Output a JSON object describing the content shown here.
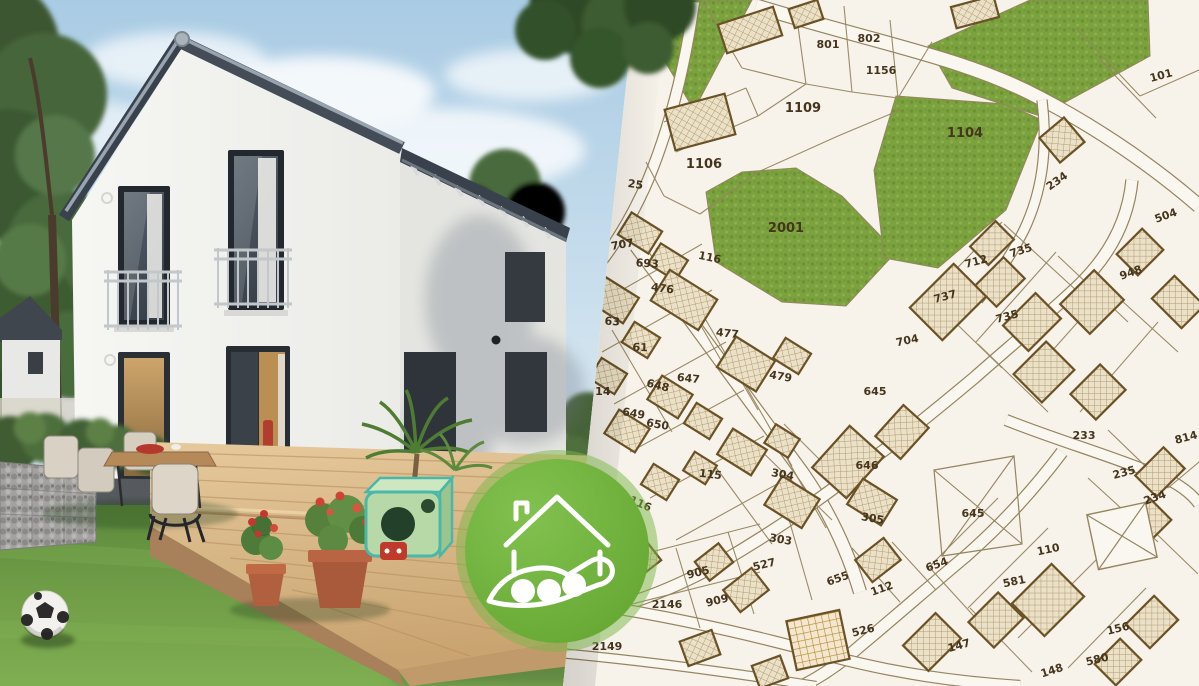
{
  "map": {
    "type": "cadastral-parcel-map",
    "colors": {
      "background": "#f7f3eb",
      "road_fill": "#faf7f0",
      "parcel_line": "#95855f",
      "building_outline": "#6b5226",
      "building_fill": "#e7dcc2",
      "green_fill": "#7ba23e",
      "label_color": "#45351d"
    },
    "green_areas": [
      "628,0 752,0 694,110",
      "706,192 742,172 796,168 842,196 896,252 846,306 782,302 716,262",
      "896,96 1006,104 1042,120 1006,210 938,268 884,258 874,170",
      "928,46 1030,0 1148,0 1150,56 1040,116 952,88"
    ],
    "roads": [
      {
        "d": "M756,6 C880,44 965,58 1040,98 C1105,132 1160,172 1199,206",
        "w": 13
      },
      {
        "d": "M1042,100 C1048,150 1042,192 1024,230 C1010,258 994,280 978,300",
        "w": 9
      },
      {
        "d": "M1132,180 C1128,222 1108,258 1076,288 C1044,318 1008,348 974,378 C938,408 904,436 868,462",
        "w": 11
      },
      {
        "d": "M636,246 C692,322 748,398 802,472 C830,512 848,552 860,592",
        "w": 12
      },
      {
        "d": "M868,462 C820,500 770,534 718,564 C672,590 622,608 572,618",
        "w": 11
      },
      {
        "d": "M1006,420 C1062,442 1112,456 1160,476 C1178,483 1192,494 1199,504",
        "w": 10
      },
      {
        "d": "M1062,452 C1032,492 1000,526 966,556 C930,586 896,616 860,646 C842,662 822,676 802,686",
        "w": 11
      },
      {
        "d": "M560,600 C652,612 742,632 830,656 C898,674 958,682 1020,686",
        "w": 10
      },
      {
        "d": "M548,652 C640,660 728,672 816,686",
        "w": 8
      },
      {
        "d": "M694,2 C686,60 672,122 648,180 C630,222 610,252 590,276",
        "w": 10
      }
    ],
    "parcel_lines": "M702,0L742,68M742,68L806,84M806,84L796,12M844,6L852,92M806,84L852,92M852,92L898,98M890,20L898,98M898,98L932,42M664,122L746,88M676,152L758,116M758,116L806,84M700,214L758,172M758,172L838,136M838,136L900,110M746,88L758,116M646,162L664,196M664,196L700,214M594,306L702,244M602,352L712,290M614,404L726,342M630,452L744,390M650,498L764,436M676,540L788,478M656,248L722,362M612,330L672,432M692,296L758,410M726,352L792,466M762,414L826,528M1002,222L928,298M1056,252L976,342M1108,288L1028,378M1158,322L1080,412M930,298L1002,368M978,344L1048,412M1004,224L1078,292M1058,256L1128,322M1110,290L1178,352M998,498L928,568M1048,528L968,608M1098,558L1018,638M1146,588L1068,668M930,568L992,636M970,608L1032,672M1088,478L1158,542M1134,512L1198,574M676,548L700,628M728,532L754,614M788,516L812,600M748,438L832,520M784,424L862,502M712,462L772,544M852,548L900,602M892,542L936,590M1076,28L1140,96M1140,96L1199,70M1100,60L1156,118M1108,430L1168,488M1168,488L1199,462M620,560L760,524M624,606L760,572",
    "buildings": [
      [
        750,
        30,
        58,
        30,
        -18
      ],
      [
        806,
        14,
        30,
        20,
        -18
      ],
      [
        700,
        122,
        62,
        42,
        -15
      ],
      [
        975,
        12,
        44,
        22,
        -15
      ],
      [
        1062,
        140,
        32,
        32,
        -40
      ],
      [
        640,
        233,
        36,
        26,
        32
      ],
      [
        668,
        262,
        32,
        24,
        32
      ],
      [
        684,
        300,
        56,
        36,
        32
      ],
      [
        614,
        300,
        40,
        30,
        32
      ],
      [
        641,
        340,
        30,
        24,
        32
      ],
      [
        746,
        364,
        46,
        36,
        32
      ],
      [
        792,
        356,
        30,
        24,
        32
      ],
      [
        608,
        376,
        30,
        24,
        32
      ],
      [
        670,
        397,
        36,
        28,
        32
      ],
      [
        703,
        421,
        30,
        24,
        32
      ],
      [
        627,
        431,
        36,
        28,
        32
      ],
      [
        742,
        452,
        40,
        30,
        32
      ],
      [
        782,
        441,
        28,
        22,
        32
      ],
      [
        700,
        468,
        26,
        22,
        32
      ],
      [
        660,
        482,
        30,
        24,
        32
      ],
      [
        792,
        502,
        44,
        34,
        32
      ],
      [
        848,
        462,
        56,
        46,
        -48
      ],
      [
        902,
        432,
        42,
        34,
        -48
      ],
      [
        872,
        502,
        40,
        30,
        32
      ],
      [
        948,
        302,
        62,
        46,
        -45
      ],
      [
        1000,
        282,
        40,
        30,
        -45
      ],
      [
        1032,
        322,
        46,
        36,
        -45
      ],
      [
        992,
        243,
        36,
        26,
        -45
      ],
      [
        1092,
        302,
        48,
        42,
        -45
      ],
      [
        1140,
        252,
        36,
        30,
        -45
      ],
      [
        1178,
        302,
        32,
        42,
        -45
      ],
      [
        1098,
        392,
        42,
        36,
        -45
      ],
      [
        1044,
        372,
        46,
        40,
        -45
      ],
      [
        1160,
        472,
        40,
        30,
        -45
      ],
      [
        1148,
        522,
        36,
        30,
        -45
      ],
      [
        1048,
        600,
        56,
        46,
        -45
      ],
      [
        996,
        620,
        42,
        36,
        -45
      ],
      [
        932,
        642,
        46,
        36,
        -45
      ],
      [
        1118,
        662,
        36,
        30,
        -45
      ],
      [
        1152,
        622,
        40,
        34,
        -45
      ],
      [
        746,
        590,
        36,
        28,
        -38
      ],
      [
        714,
        562,
        30,
        24,
        -38
      ],
      [
        878,
        560,
        36,
        28,
        -38
      ],
      [
        642,
        560,
        30,
        24,
        -38
      ],
      [
        700,
        648,
        34,
        26,
        -20
      ],
      [
        770,
        672,
        30,
        24,
        -20
      ]
    ],
    "grid_building": [
      818,
      640,
      54,
      50,
      -12
    ],
    "crossed_building": [
      1122,
      536,
      60,
      56,
      -12
    ],
    "crossed_parcel": "934,470 1014,456 1022,544 942,556",
    "parcel_labels": [
      {
        "t": "801",
        "x": 828,
        "y": 48,
        "r": 0
      },
      {
        "t": "802",
        "x": 869,
        "y": 42,
        "r": 0
      },
      {
        "t": "1156",
        "x": 881,
        "y": 74,
        "r": 0
      },
      {
        "t": "101",
        "x": 1162,
        "y": 79,
        "r": -15
      },
      {
        "t": "1109",
        "x": 803,
        "y": 112,
        "r": 0,
        "s": 13
      },
      {
        "t": "1104",
        "x": 965,
        "y": 137,
        "r": 0,
        "s": 13
      },
      {
        "t": "1106",
        "x": 704,
        "y": 168,
        "r": 0,
        "s": 13
      },
      {
        "t": "25",
        "x": 635,
        "y": 188,
        "r": 8
      },
      {
        "t": "234",
        "x": 1059,
        "y": 184,
        "r": -35
      },
      {
        "t": "2001",
        "x": 786,
        "y": 232,
        "r": 0,
        "s": 13
      },
      {
        "t": "707",
        "x": 623,
        "y": 248,
        "r": -10
      },
      {
        "t": "116",
        "x": 709,
        "y": 261,
        "r": 12
      },
      {
        "t": "693",
        "x": 647,
        "y": 267,
        "r": 4
      },
      {
        "t": "476",
        "x": 662,
        "y": 292,
        "r": 8
      },
      {
        "t": "735",
        "x": 1022,
        "y": 254,
        "r": -18
      },
      {
        "t": "712",
        "x": 977,
        "y": 265,
        "r": -15
      },
      {
        "t": "737",
        "x": 946,
        "y": 300,
        "r": -15
      },
      {
        "t": "504",
        "x": 1167,
        "y": 219,
        "r": -20
      },
      {
        "t": "63",
        "x": 612,
        "y": 325,
        "r": 4
      },
      {
        "t": "735",
        "x": 1008,
        "y": 320,
        "r": -15
      },
      {
        "t": "477",
        "x": 727,
        "y": 337,
        "r": 6
      },
      {
        "t": "704",
        "x": 908,
        "y": 344,
        "r": -12
      },
      {
        "t": "61",
        "x": 640,
        "y": 351,
        "r": 2
      },
      {
        "t": "948",
        "x": 1132,
        "y": 276,
        "r": -20
      },
      {
        "t": "647",
        "x": 688,
        "y": 382,
        "r": 6
      },
      {
        "t": "648",
        "x": 657,
        "y": 389,
        "r": 14
      },
      {
        "t": "479",
        "x": 780,
        "y": 380,
        "r": 10
      },
      {
        "t": "714",
        "x": 599,
        "y": 395,
        "r": 0
      },
      {
        "t": "645",
        "x": 875,
        "y": 395,
        "r": 0
      },
      {
        "t": "649",
        "x": 633,
        "y": 417,
        "r": 10
      },
      {
        "t": "650",
        "x": 657,
        "y": 428,
        "r": 10
      },
      {
        "t": "233",
        "x": 1084,
        "y": 439,
        "r": 0
      },
      {
        "t": "814",
        "x": 1187,
        "y": 441,
        "r": -15
      },
      {
        "t": "646",
        "x": 867,
        "y": 469,
        "r": 0
      },
      {
        "t": "115",
        "x": 710,
        "y": 478,
        "r": 6
      },
      {
        "t": "304",
        "x": 782,
        "y": 478,
        "r": 10
      },
      {
        "t": "235",
        "x": 1125,
        "y": 476,
        "r": -15
      },
      {
        "t": "234",
        "x": 1156,
        "y": 501,
        "r": -20
      },
      {
        "t": "116",
        "x": 639,
        "y": 507,
        "r": 24
      },
      {
        "t": "645",
        "x": 973,
        "y": 517,
        "r": 0
      },
      {
        "t": "305",
        "x": 872,
        "y": 522,
        "r": 10
      },
      {
        "t": "303",
        "x": 780,
        "y": 543,
        "r": 10
      },
      {
        "t": "110",
        "x": 1049,
        "y": 553,
        "r": -12
      },
      {
        "t": "654",
        "x": 938,
        "y": 568,
        "r": -20
      },
      {
        "t": "905",
        "x": 699,
        "y": 576,
        "r": -14
      },
      {
        "t": "527",
        "x": 765,
        "y": 568,
        "r": -14
      },
      {
        "t": "655",
        "x": 839,
        "y": 582,
        "r": -20
      },
      {
        "t": "112",
        "x": 883,
        "y": 592,
        "r": -20
      },
      {
        "t": "581",
        "x": 1015,
        "y": 585,
        "r": -12
      },
      {
        "t": "909",
        "x": 718,
        "y": 604,
        "r": -14
      },
      {
        "t": "2146",
        "x": 667,
        "y": 608,
        "r": 0
      },
      {
        "t": "526",
        "x": 864,
        "y": 634,
        "r": -14
      },
      {
        "t": "156",
        "x": 1119,
        "y": 632,
        "r": -14
      },
      {
        "t": "2149",
        "x": 607,
        "y": 650,
        "r": 0
      },
      {
        "t": "147",
        "x": 960,
        "y": 649,
        "r": -16
      },
      {
        "t": "580",
        "x": 1098,
        "y": 663,
        "r": -14
      },
      {
        "t": "148",
        "x": 1053,
        "y": 674,
        "r": -18
      }
    ]
  },
  "photo": {
    "colors": {
      "sky": "#aecde5",
      "wall": "#f3f3f0",
      "roof": "#39414c",
      "deck_wood": "#dcba8a",
      "grass": "#6f9c46"
    }
  },
  "badge": {
    "color": "#72b23c",
    "ring_color": "#7ab648",
    "icon": "house-in-hand-icon",
    "icon_color": "#ffffff"
  }
}
